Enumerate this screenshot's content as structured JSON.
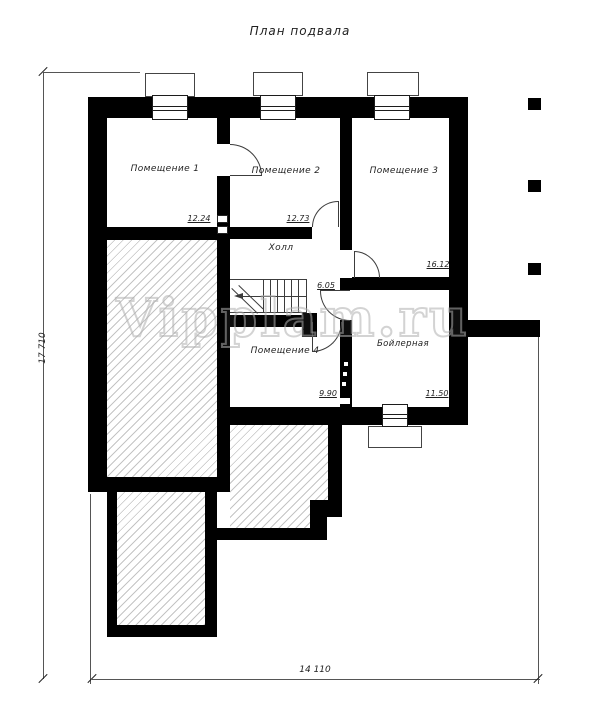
{
  "title": "План подвала",
  "watermark": "Vipplam.ru",
  "rooms": [
    {
      "name": "Помещение 1",
      "area": "12.24"
    },
    {
      "name": "Помещение 2",
      "area": "12.73"
    },
    {
      "name": "Помещение 3",
      "area": "16.12"
    },
    {
      "name": "Холл",
      "area": "6.05"
    },
    {
      "name": "Помещение 4",
      "area": "9.90"
    },
    {
      "name": "Бойлерная",
      "area": "11.50"
    }
  ],
  "dimensions": {
    "overall_height_mm": "17 710",
    "overall_width_mm": "14 110"
  },
  "colors": {
    "wall": "#000000",
    "line": "#3c3c3c",
    "hatch": "#c4c4c4",
    "watermark": "#c8c8c8"
  }
}
